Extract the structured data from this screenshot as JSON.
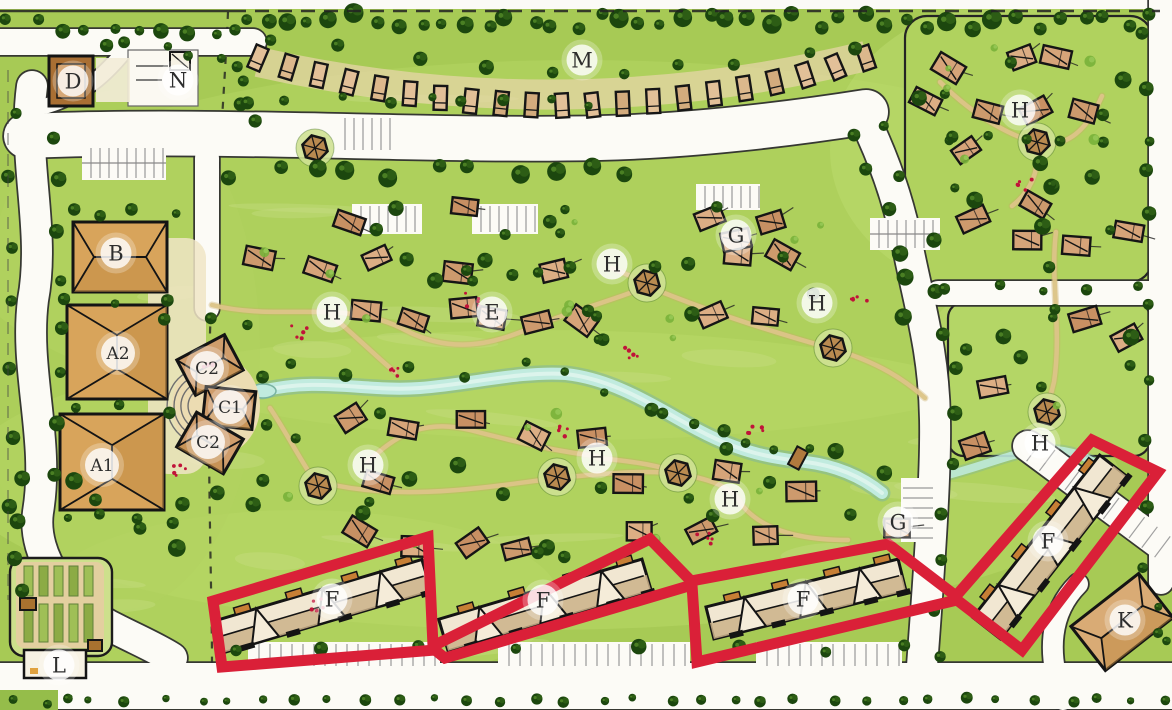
{
  "palette": {
    "grass": "#a7ca55",
    "grass_light": "#b6d764",
    "canopy": "#1c470e",
    "cottage": "#d2a074",
    "building": "#d8a45b",
    "road": "#fcfbf6",
    "road_edge": "#2f2f2f",
    "stream": "#c1ebdf",
    "path_tan": "#dcc488",
    "highlight_red": "#da2038",
    "badge_bg": "#ffffff",
    "badge_text": "#2d2d2d"
  },
  "labels": [
    {
      "text": "D",
      "x": 73,
      "y": 81
    },
    {
      "text": "N",
      "x": 178,
      "y": 80
    },
    {
      "text": "M",
      "x": 582,
      "y": 60
    },
    {
      "text": "B",
      "x": 116,
      "y": 253
    },
    {
      "text": "A2",
      "x": 118,
      "y": 353
    },
    {
      "text": "A1",
      "x": 102,
      "y": 465
    },
    {
      "text": "C2",
      "x": 207,
      "y": 368
    },
    {
      "text": "C1",
      "x": 230,
      "y": 407
    },
    {
      "text": "C2",
      "x": 208,
      "y": 442
    },
    {
      "text": "E",
      "x": 492,
      "y": 312
    },
    {
      "text": "H",
      "x": 332,
      "y": 312
    },
    {
      "text": "H",
      "x": 612,
      "y": 264
    },
    {
      "text": "G",
      "x": 736,
      "y": 235
    },
    {
      "text": "H",
      "x": 817,
      "y": 303
    },
    {
      "text": "H",
      "x": 1020,
      "y": 110
    },
    {
      "text": "H",
      "x": 368,
      "y": 465
    },
    {
      "text": "H",
      "x": 597,
      "y": 458
    },
    {
      "text": "H",
      "x": 730,
      "y": 499
    },
    {
      "text": "G",
      "x": 898,
      "y": 522
    },
    {
      "text": "H",
      "x": 1040,
      "y": 443
    },
    {
      "text": "F",
      "x": 332,
      "y": 599
    },
    {
      "text": "F",
      "x": 543,
      "y": 600
    },
    {
      "text": "F",
      "x": 803,
      "y": 599
    },
    {
      "text": "F",
      "x": 1048,
      "y": 541
    },
    {
      "text": "K",
      "x": 1125,
      "y": 620
    },
    {
      "text": "L",
      "x": 59,
      "y": 665
    }
  ],
  "pavilions": [
    {
      "x": 315,
      "y": 148
    },
    {
      "x": 647,
      "y": 283
    },
    {
      "x": 833,
      "y": 348
    },
    {
      "x": 318,
      "y": 486
    },
    {
      "x": 557,
      "y": 477
    },
    {
      "x": 678,
      "y": 473
    },
    {
      "x": 1037,
      "y": 142
    },
    {
      "x": 1047,
      "y": 412
    }
  ],
  "highlight_route": {
    "color": "#da2038",
    "width": 11,
    "points": [
      [
        213,
        601
      ],
      [
        428,
        537
      ],
      [
        433,
        646
      ],
      [
        650,
        539
      ],
      [
        691,
        581
      ],
      [
        888,
        544
      ],
      [
        956,
        596
      ],
      [
        1092,
        440
      ],
      [
        1158,
        472
      ],
      [
        1022,
        650
      ],
      [
        957,
        600
      ],
      [
        697,
        662
      ],
      [
        692,
        585
      ],
      [
        445,
        658
      ],
      [
        435,
        650
      ],
      [
        222,
        667
      ]
    ]
  }
}
